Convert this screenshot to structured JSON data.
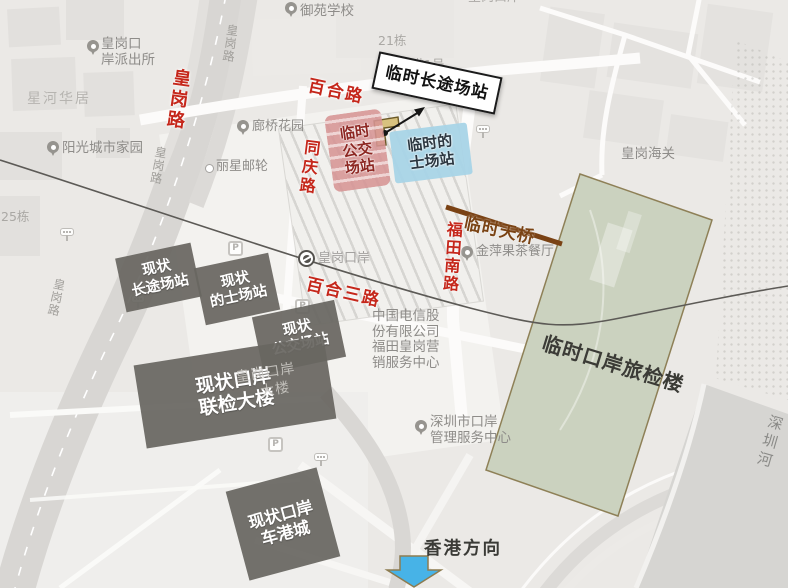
{
  "colors": {
    "road_label_red": "#c5271b",
    "overlay_dark_gray": "#686661",
    "temp_bus_pink": "#d69494",
    "temp_taxi_blue": "#a8d4e7",
    "temp_bridge_brown": "#7a4314",
    "temp_terminal_green": "#cbd2bf",
    "direction_arrow_blue": "#47b3e7"
  },
  "base_labels": {
    "top_clipped": "皇岗口岸",
    "school": "御苑学校",
    "building21": "21栋",
    "shengang1": "深港1号",
    "police_l1": "皇岗口",
    "police_l2": "岸派出所",
    "xinghe": "星河华居",
    "yangguang": "阳光城市家园",
    "building25": "25栋",
    "langqiao": "廊桥花园",
    "lixing": "丽星邮轮",
    "metro": "皇岗口岸",
    "customs": "皇岗海关",
    "restaurant": "金萍果茶餐厅",
    "telecom_l1": "中国电信股",
    "telecom_l2": "份有限公司",
    "telecom_l3": "福田皇岗营",
    "telecom_l4": "销服务中心",
    "port_center_l1": "深圳市口岸",
    "port_center_l2": "管理服务中心",
    "port_bldg_l1": "皇岗口岸",
    "port_bldg_l2": "大楼",
    "river": "深圳河",
    "parking_letter": "P"
  },
  "road_labels": {
    "huanggang_red": "皇岗路",
    "huanggang_gray_top": "皇岗路",
    "huanggang_gray_mid": "皇岗路",
    "huanggang_gray_low": "皇岗路",
    "baihe": "百合路",
    "tongqing": "同庆路",
    "futiannan": "福田南路",
    "baihe3": "百合三路"
  },
  "temporary": {
    "longdistance": "临时长途场站",
    "bus_l1": "临时",
    "bus_l2": "公交",
    "bus_l3": "场站",
    "taxi_l1": "临时的",
    "taxi_l2": "士场站",
    "bridge": "临时天桥",
    "terminal": "临时口岸旅检楼"
  },
  "current": {
    "longdist_l1": "现状",
    "longdist_l2": "长途场站",
    "taxi_l1": "现状",
    "taxi_l2": "的士场站",
    "bus_l1": "现状",
    "bus_l2": "公交场站",
    "joint_l1": "现状口岸",
    "joint_l2": "联检大楼",
    "carport_l1": "现状口岸",
    "carport_l2": "车港城"
  },
  "direction": {
    "hongkong": "香港方向"
  }
}
